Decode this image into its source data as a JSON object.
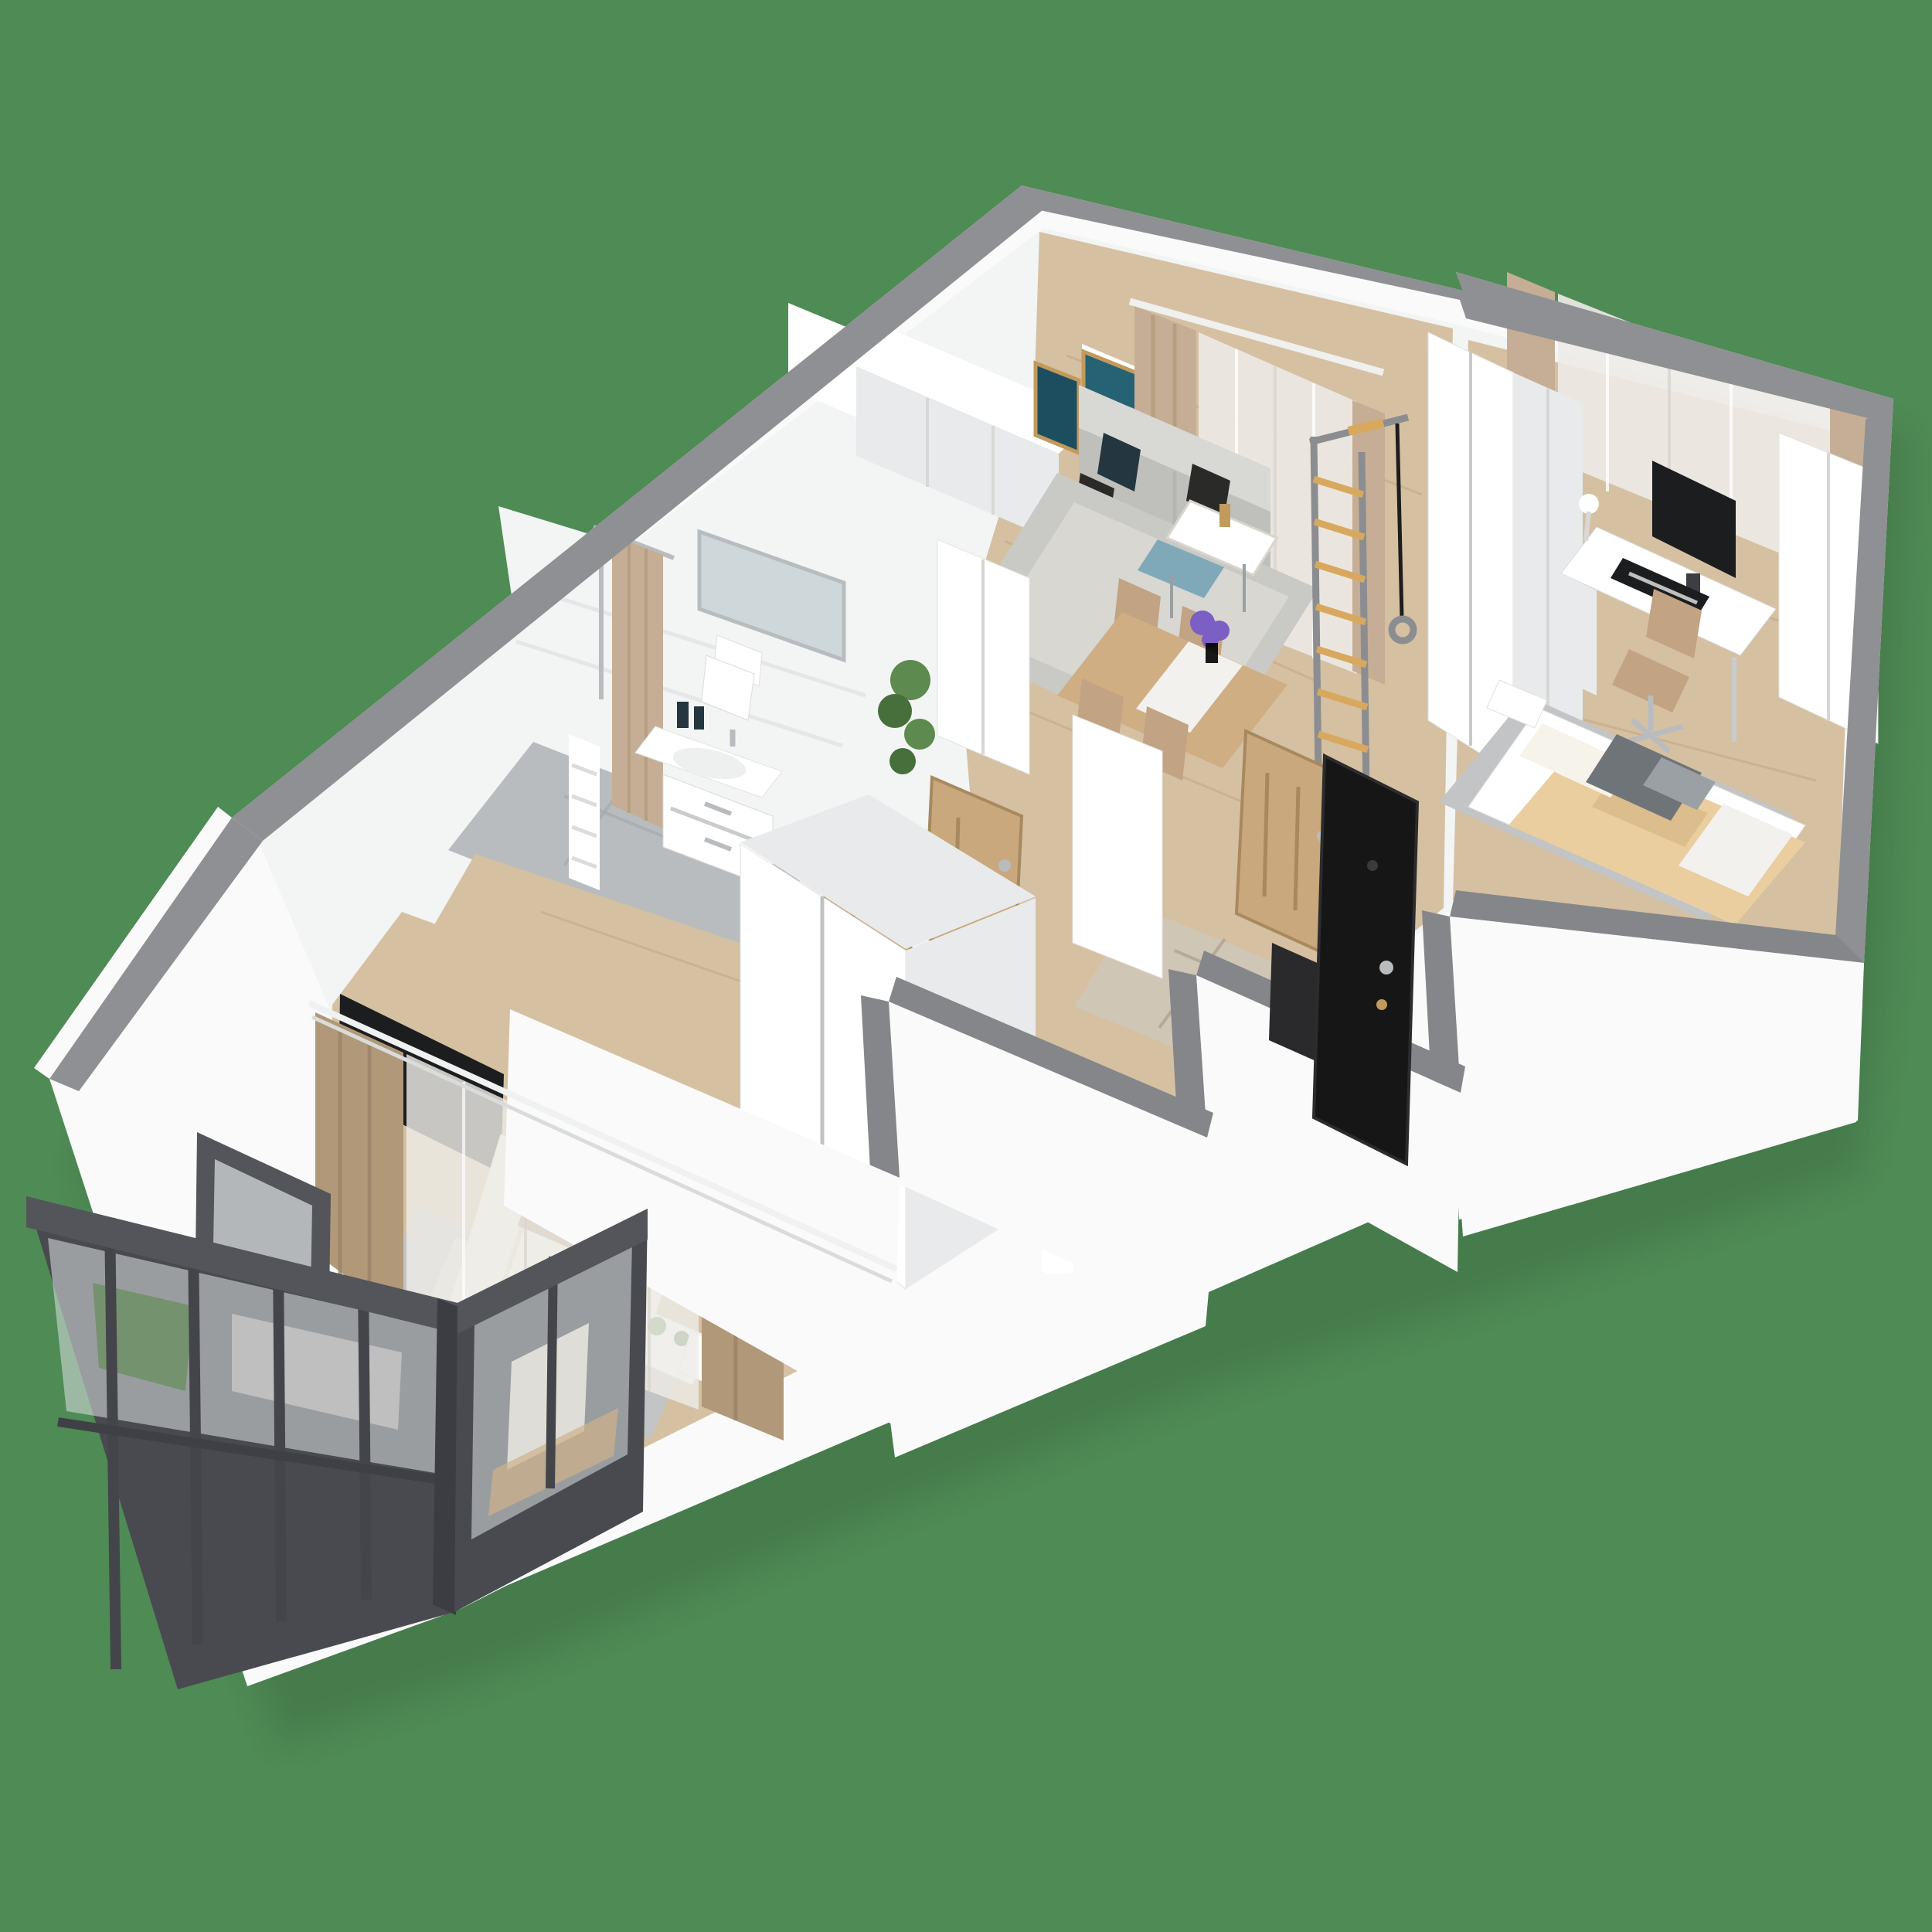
{
  "scene": {
    "kind": "3d-floor-plan-render",
    "label": "Perspective 3D cutaway floor plan of a two-bedroom apartment on a green background",
    "background_color": "#4f8b55"
  },
  "palette": {
    "bg": "#4f8b55",
    "wallTop": "#8f9093",
    "wallTopFront": "#84868a",
    "wallWhite": "#fafafa",
    "wallShade": "#e8eaeb",
    "interior": "#f3f4f4",
    "wood": "#d6c0a2",
    "woodLine": "#c0a685",
    "tile": "#b9bcbe",
    "stone": "#cfc6b6",
    "oak": "#c9a87d",
    "oakDark": "#a8895f",
    "doorBlack": "#161616",
    "frameDark": "#54555a",
    "framePanel": "#494a4f",
    "glass": "#dde1e3",
    "curtain": "#c5ae95",
    "curtainDark": "#b09878",
    "sheer": "#edebe7",
    "sofa": "#d8d8d5",
    "sofaShade": "#bfbfbc",
    "pillowNavy": "#24363f",
    "pillowBlack": "#2a2b28",
    "rug": "#c9c9c5",
    "rugInner": "#d8d7d2",
    "rugGray": "#c2c4c6",
    "tableWood": "#cfae84",
    "runnerWhite": "#f2f1ee",
    "chairTan": "#c2a384",
    "blanket": "#eace9f",
    "blanketShade": "#dcbd8e",
    "throw": "#a98c72",
    "clothes": "#6f7478",
    "clothesLight": "#9aa0a4",
    "plant": "#5d8a4e",
    "plantDark": "#466f3b",
    "flower": "#7b5fc4",
    "art1": "#256274",
    "art2": "#1d4e60",
    "gold": "#c19a5c",
    "chrome": "#b9bcbf",
    "gymRail": "#8b8d90",
    "gymRung": "#d9a85f",
    "screenBlack": "#1c1d1f",
    "cream": "#f6f3ea"
  },
  "rooms": [
    {
      "id": "living-room",
      "name": "living-dining-room",
      "items": [
        "gray-sofa",
        "navy-pillows",
        "nesting-coffee-tables",
        "gold-vase",
        "area-rug",
        "dining-table",
        "white-table-runner",
        "purple-flower-vase",
        "tan-dining-chairs",
        "beige-curtains",
        "sheer-curtains",
        "two-teal-wall-artworks",
        "swedish-wall-bars",
        "gymnastic-rings"
      ]
    },
    {
      "id": "kitchen",
      "name": "kitchen-corner",
      "items": [
        "white-cabinet-run",
        "tall-white-column-cabinet"
      ]
    },
    {
      "id": "bedroom-right",
      "name": "bedroom-office",
      "items": [
        "white-wardrobes",
        "white-desk",
        "black-monitor",
        "black-keyboard",
        "desk-lamp",
        "tan-office-chair",
        "gray-rug",
        "bed-with-beige-blanket",
        "white-pillows",
        "gray-clothes-pile",
        "sheer-and-beige-curtains",
        "white-nightstand"
      ]
    },
    {
      "id": "bathroom",
      "name": "bathroom",
      "items": [
        "white-vanity-with-sink",
        "chrome-faucet",
        "soap-bottles",
        "toilet",
        "beige-shower-curtain",
        "shower-riser",
        "towel-radiator",
        "wall-mirror",
        "gray-tile-floor"
      ]
    },
    {
      "id": "hallway",
      "name": "entrance-hall-and-corridor",
      "items": [
        "black-entrance-door-open",
        "oak-interior-doors",
        "tall-white-storage-cabinets",
        "potted-plant",
        "stone-entry-floor",
        "wood-corridor-floor"
      ]
    },
    {
      "id": "bedroom-left",
      "name": "master-bedroom",
      "items": [
        "sliding-door-wardrobe",
        "wall-mounted-tv",
        "double-bed-cream-striped-duvet",
        "brown-throw",
        "white-pillows",
        "windowsill-shelf-with-plants",
        "gray-rug",
        "white-nightstand",
        "tall-plant-in-white-vase",
        "beige-and-sheer-curtains",
        "white-curtain-rail"
      ]
    },
    {
      "id": "balcony",
      "name": "glazed-balcony",
      "items": [
        "charcoal-window-frames",
        "glass-panels",
        "dark-lower-panels",
        "balcony-door-dark-frame",
        "indoor-plant",
        "white-armchair",
        "wood-decking"
      ]
    }
  ]
}
